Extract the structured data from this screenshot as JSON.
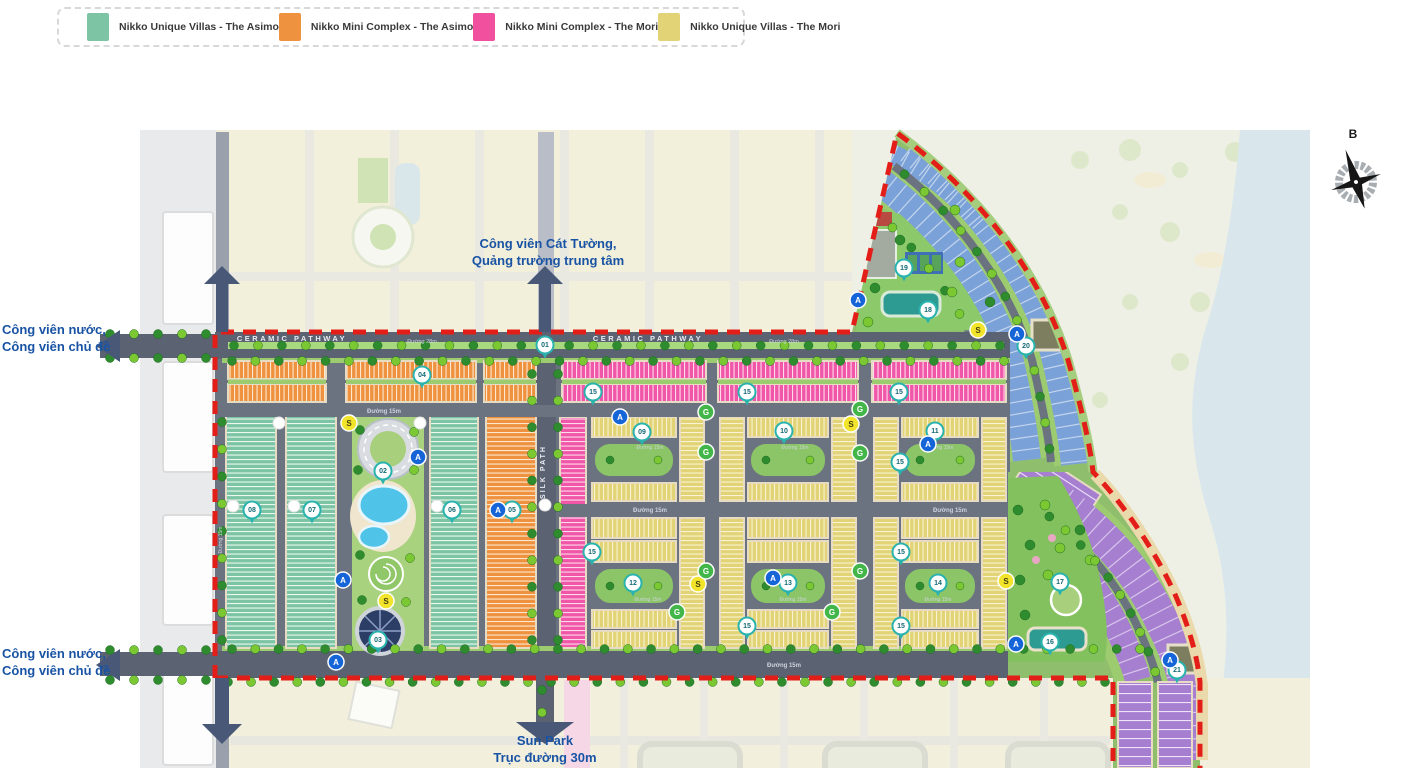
{
  "legend": {
    "items": [
      {
        "label": "Nikko Unique Villas - The Asimo",
        "color": "#7cc4a4"
      },
      {
        "label": "Nikko Mini Complex - The Asimo",
        "color": "#ef9240"
      },
      {
        "label": "Nikko Mini Complex - The Mori",
        "color": "#f1509f"
      },
      {
        "label": "Nikko Unique Villas - The Mori",
        "color": "#e2d476"
      }
    ]
  },
  "compass": {
    "label": "B"
  },
  "annotations": {
    "top_park": {
      "lines": [
        "Công viên Cát Tường,",
        "Quảng trường trung tâm"
      ]
    },
    "left_park_top": {
      "lines": [
        "Công viên nước,",
        "Công viên chủ đề"
      ]
    },
    "left_park_bottom": {
      "lines": [
        "Công viên nước,",
        "Công viên chủ đề"
      ]
    },
    "sun_park": {
      "lines": [
        "Sun Park",
        "Trục đường 30m"
      ]
    }
  },
  "road_labels": [
    {
      "text": "CERAMIC PATHWAY",
      "x": 292,
      "y": 341,
      "size": 7.5,
      "ls": 2.5
    },
    {
      "text": "CERAMIC PATHWAY",
      "x": 648,
      "y": 341,
      "size": 7.5,
      "ls": 2.5
    },
    {
      "text": "Đường 28m",
      "x": 422,
      "y": 343,
      "size": 5.5
    },
    {
      "text": "Đường 28m",
      "x": 784,
      "y": 343,
      "size": 5.5
    },
    {
      "text": "Đường 15m",
      "x": 384,
      "y": 413,
      "size": 6
    },
    {
      "text": "Đường 15m",
      "x": 650,
      "y": 512,
      "size": 6
    },
    {
      "text": "Đường 15m",
      "x": 950,
      "y": 512,
      "size": 6
    },
    {
      "text": "Đường 15m",
      "x": 784,
      "y": 667,
      "size": 6
    },
    {
      "text": "Đường 15m",
      "x": 650,
      "y": 449,
      "size": 5
    },
    {
      "text": "Đường 15m",
      "x": 795,
      "y": 449,
      "size": 5
    },
    {
      "text": "Đường 15m",
      "x": 940,
      "y": 449,
      "size": 5
    },
    {
      "text": "Đường 15m",
      "x": 648,
      "y": 601,
      "size": 5
    },
    {
      "text": "Đường 15m",
      "x": 793,
      "y": 601,
      "size": 5
    },
    {
      "text": "Đường 15m",
      "x": 938,
      "y": 601,
      "size": 5
    },
    {
      "text": "Đường 15m",
      "x": 222,
      "y": 540,
      "size": 5,
      "rotate": -90
    },
    {
      "text": "SILK PATH",
      "x": 545,
      "y": 472,
      "size": 7,
      "ls": 2,
      "rotate": -90
    }
  ],
  "badges": {
    "pins": [
      {
        "n": "01",
        "x": 545,
        "y": 345
      },
      {
        "n": "02",
        "x": 383,
        "y": 471
      },
      {
        "n": "03",
        "x": 378,
        "y": 640
      },
      {
        "n": "04",
        "x": 422,
        "y": 375
      },
      {
        "n": "05",
        "x": 512,
        "y": 510
      },
      {
        "n": "06",
        "x": 452,
        "y": 510
      },
      {
        "n": "07",
        "x": 312,
        "y": 510
      },
      {
        "n": "08",
        "x": 252,
        "y": 510
      },
      {
        "n": "09",
        "x": 642,
        "y": 432
      },
      {
        "n": "10",
        "x": 784,
        "y": 431
      },
      {
        "n": "11",
        "x": 935,
        "y": 431
      },
      {
        "n": "12",
        "x": 633,
        "y": 583
      },
      {
        "n": "13",
        "x": 788,
        "y": 583
      },
      {
        "n": "14",
        "x": 938,
        "y": 583
      },
      {
        "n": "15",
        "x": 593,
        "y": 392
      },
      {
        "n": "15",
        "x": 747,
        "y": 392
      },
      {
        "n": "15",
        "x": 899,
        "y": 392
      },
      {
        "n": "15",
        "x": 900,
        "y": 462
      },
      {
        "n": "15",
        "x": 592,
        "y": 552
      },
      {
        "n": "15",
        "x": 901,
        "y": 552
      },
      {
        "n": "15",
        "x": 747,
        "y": 626
      },
      {
        "n": "15",
        "x": 901,
        "y": 626
      },
      {
        "n": "16",
        "x": 1050,
        "y": 642
      },
      {
        "n": "17",
        "x": 1060,
        "y": 582
      },
      {
        "n": "18",
        "x": 928,
        "y": 310
      },
      {
        "n": "19",
        "x": 904,
        "y": 268
      },
      {
        "n": "20",
        "x": 1026,
        "y": 346
      },
      {
        "n": "21",
        "x": 1177,
        "y": 670
      }
    ],
    "a": [
      {
        "x": 418,
        "y": 457
      },
      {
        "x": 498,
        "y": 510
      },
      {
        "x": 343,
        "y": 580
      },
      {
        "x": 336,
        "y": 662
      },
      {
        "x": 620,
        "y": 417
      },
      {
        "x": 928,
        "y": 444
      },
      {
        "x": 773,
        "y": 578
      },
      {
        "x": 858,
        "y": 300
      },
      {
        "x": 1017,
        "y": 334
      },
      {
        "x": 1016,
        "y": 644
      },
      {
        "x": 1170,
        "y": 660
      }
    ],
    "s": [
      {
        "x": 349,
        "y": 423
      },
      {
        "x": 851,
        "y": 424
      },
      {
        "x": 386,
        "y": 601
      },
      {
        "x": 698,
        "y": 584
      },
      {
        "x": 978,
        "y": 330
      },
      {
        "x": 1006,
        "y": 581
      }
    ],
    "g": [
      {
        "x": 706,
        "y": 412
      },
      {
        "x": 706,
        "y": 452
      },
      {
        "x": 860,
        "y": 409
      },
      {
        "x": 860,
        "y": 453
      },
      {
        "x": 706,
        "y": 571
      },
      {
        "x": 860,
        "y": 571
      },
      {
        "x": 677,
        "y": 612
      },
      {
        "x": 832,
        "y": 612
      }
    ],
    "a_label": "A",
    "s_label": "S",
    "g_label": "G"
  },
  "colors": {
    "boundary_red": "#e31e18",
    "road": "#6b7380",
    "road_dark": "#5b6271",
    "teal": "#7cc4a4",
    "orange": "#ef9240",
    "pink": "#f157a8",
    "yellow": "#e2d476",
    "blue": "#7ba2d8",
    "purple": "#a77fd1",
    "park_green": "#8cc468",
    "strip_green": "#9ccb70",
    "water": "#d9e7ec",
    "sand": "#ead9ab",
    "tree_dark": "#2e8b2e",
    "tree_light": "#7cc832",
    "label_blue": "#1953a4"
  }
}
